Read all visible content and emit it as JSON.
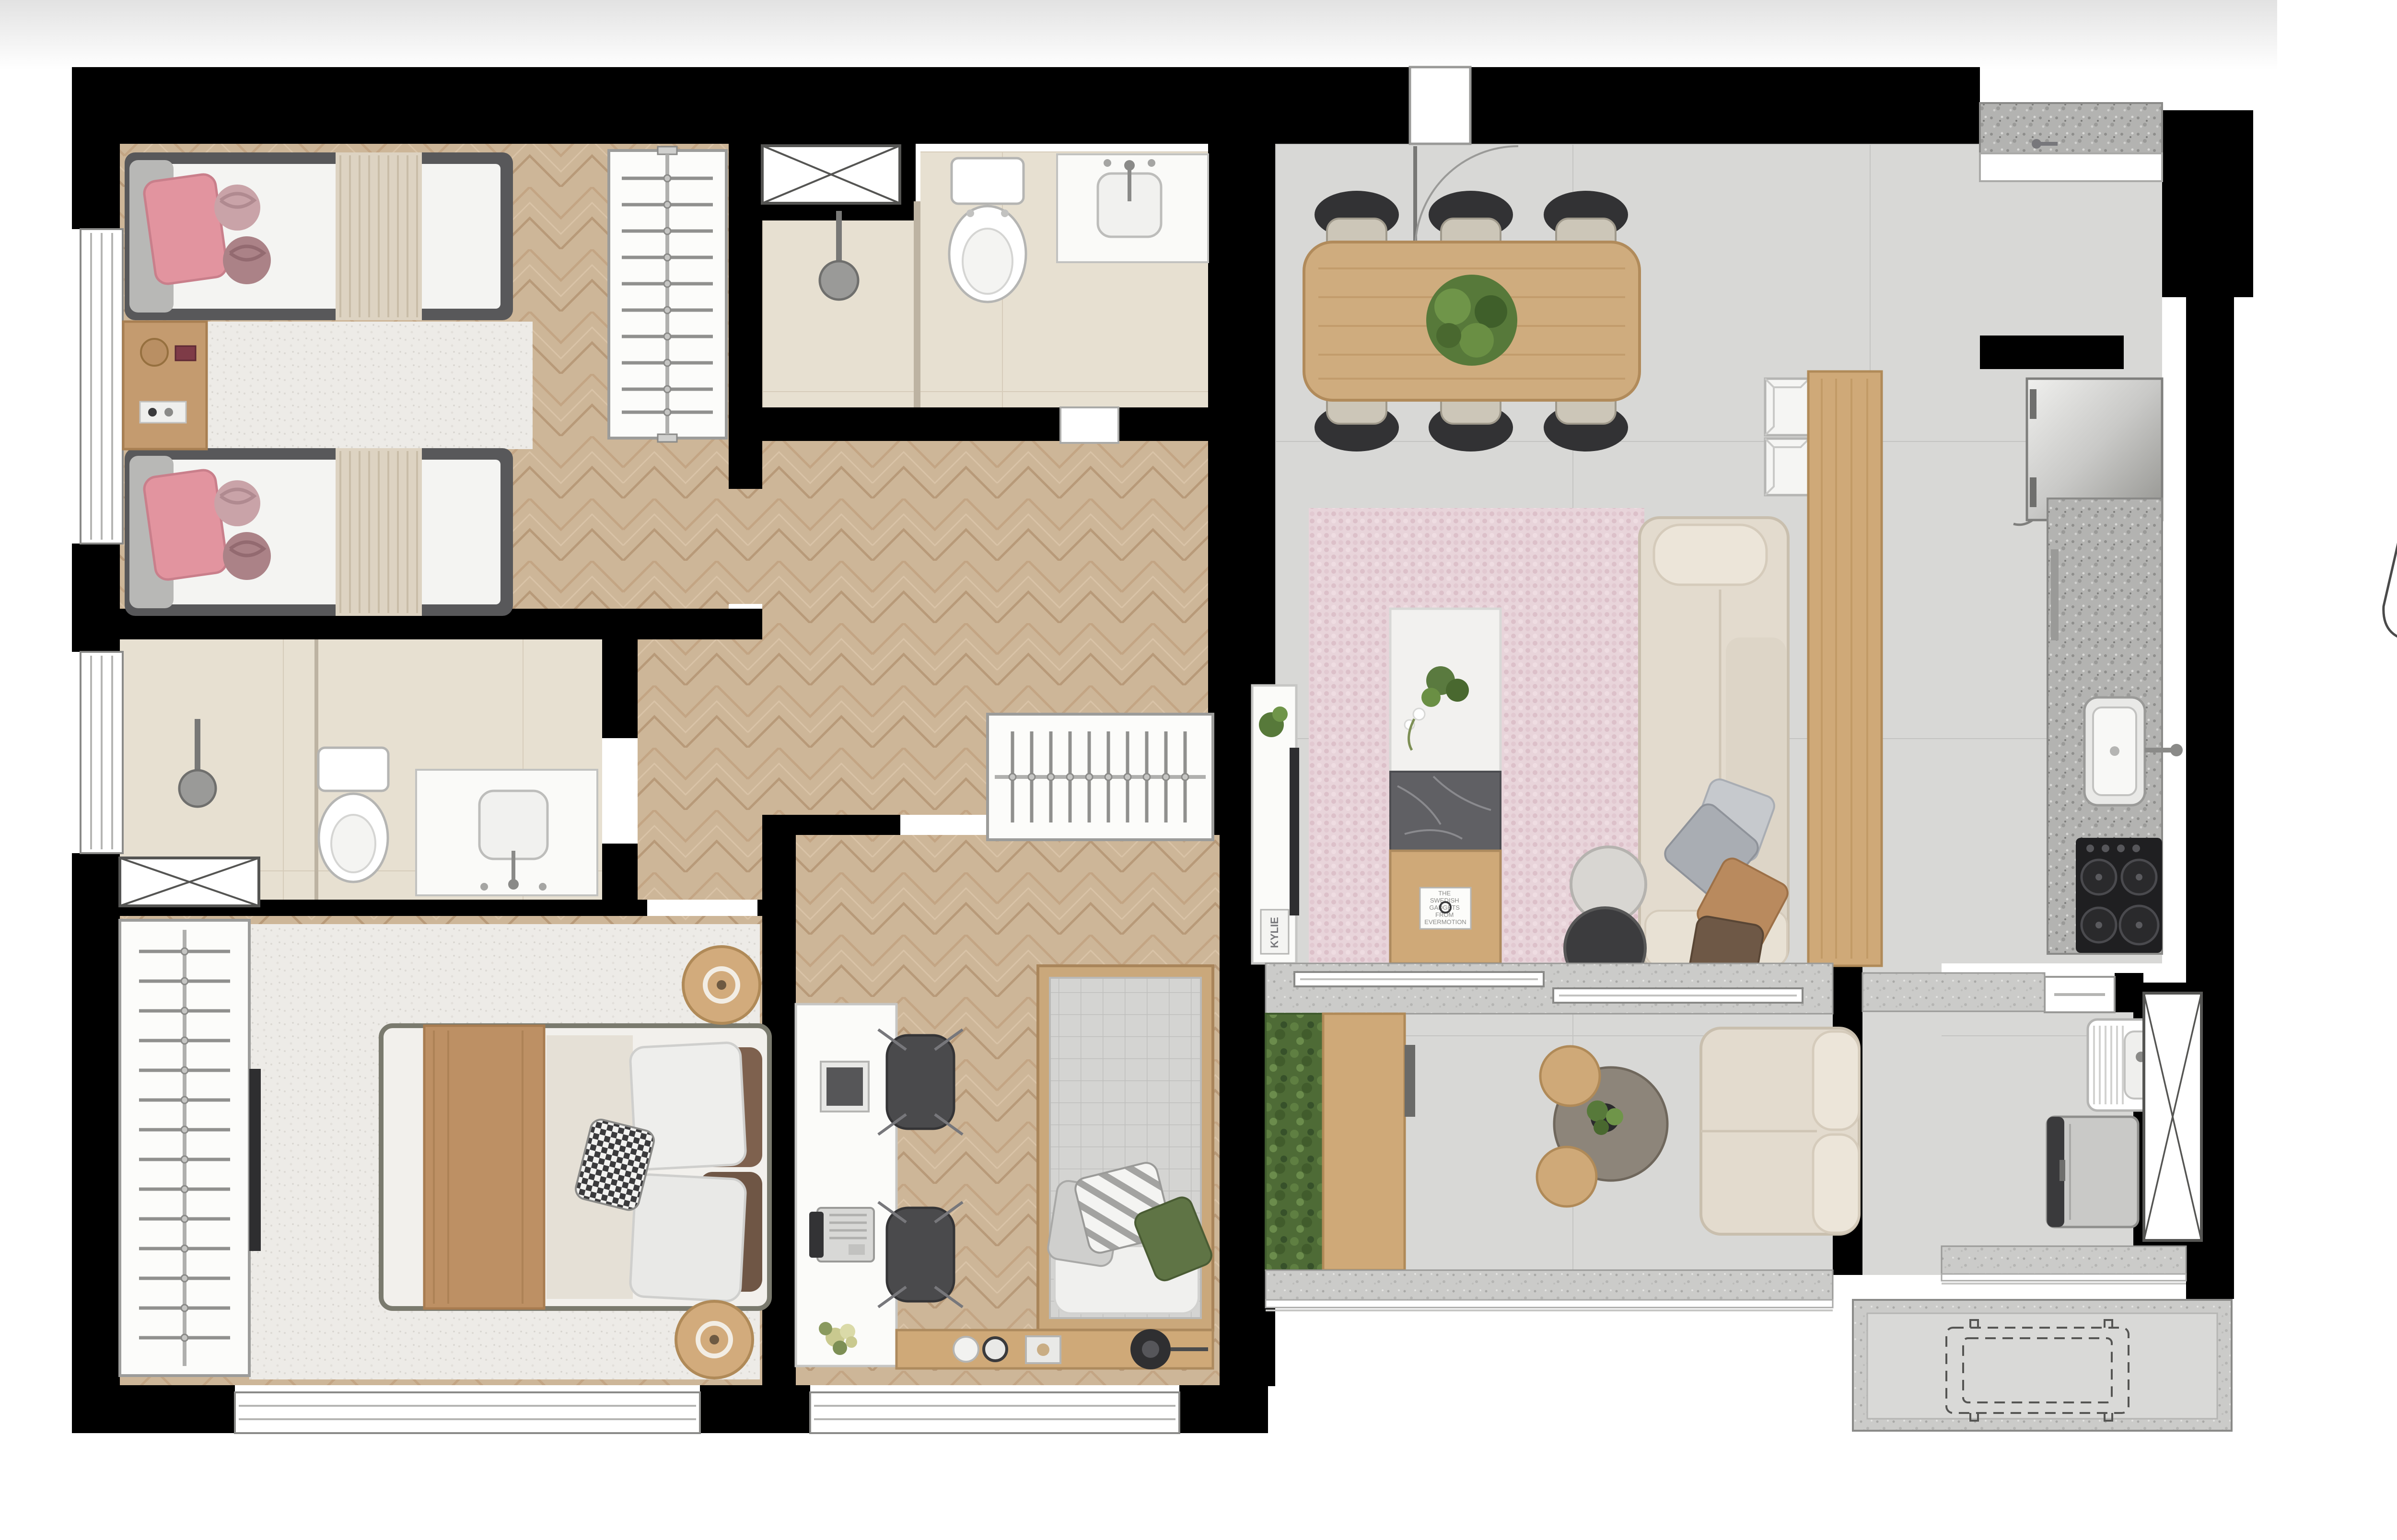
{
  "page": {
    "background": "#ffffff"
  },
  "floor_plan": {
    "colors": {
      "wall": "#000000",
      "wood_floor": "#cdb698",
      "wood_floor_line": "#b89a79",
      "tile_gray": "#d8d8d6",
      "tile_bath": "#e7e0d1",
      "granite": "#b5b5b3",
      "wood_furniture": "#cfa978",
      "sofa_beige": "#e3dbce",
      "rug_pink": "#e8d4da",
      "rug_light": "#edebe7",
      "chair_dark": "#3a3a3c",
      "plant_green": "#57793a",
      "pink_pillow": "#e2949f",
      "throw_tan": "#bd9064"
    },
    "decor_texts": {
      "book_kylie": "KYLIE",
      "coffee_book_lines": [
        "THE",
        "SWEDISH",
        "GADGETS",
        "FROM",
        "EVERMOTION"
      ]
    }
  },
  "site_plan": {
    "street_top": "AVENIDA PREFEITO HIRANT SANAZAR",
    "street_bottom": "AVENIDA ANALICE SAKATAUSKAS",
    "portaria": "PORTARIA",
    "tower_a": {
      "access_label": "Acesso a torre A",
      "units": [
        "5",
        "4",
        "6",
        "3",
        "1",
        "2"
      ]
    },
    "tower_b": {
      "access_label": "Acesso a torre B",
      "units": [
        "1",
        "2",
        "6",
        "3",
        "5",
        "4"
      ]
    },
    "access_development_lines": [
      "Acesso",
      "ao",
      "Empreendimento"
    ],
    "highlighted_unit": "5",
    "highlight_color": "#d9d9d9"
  }
}
